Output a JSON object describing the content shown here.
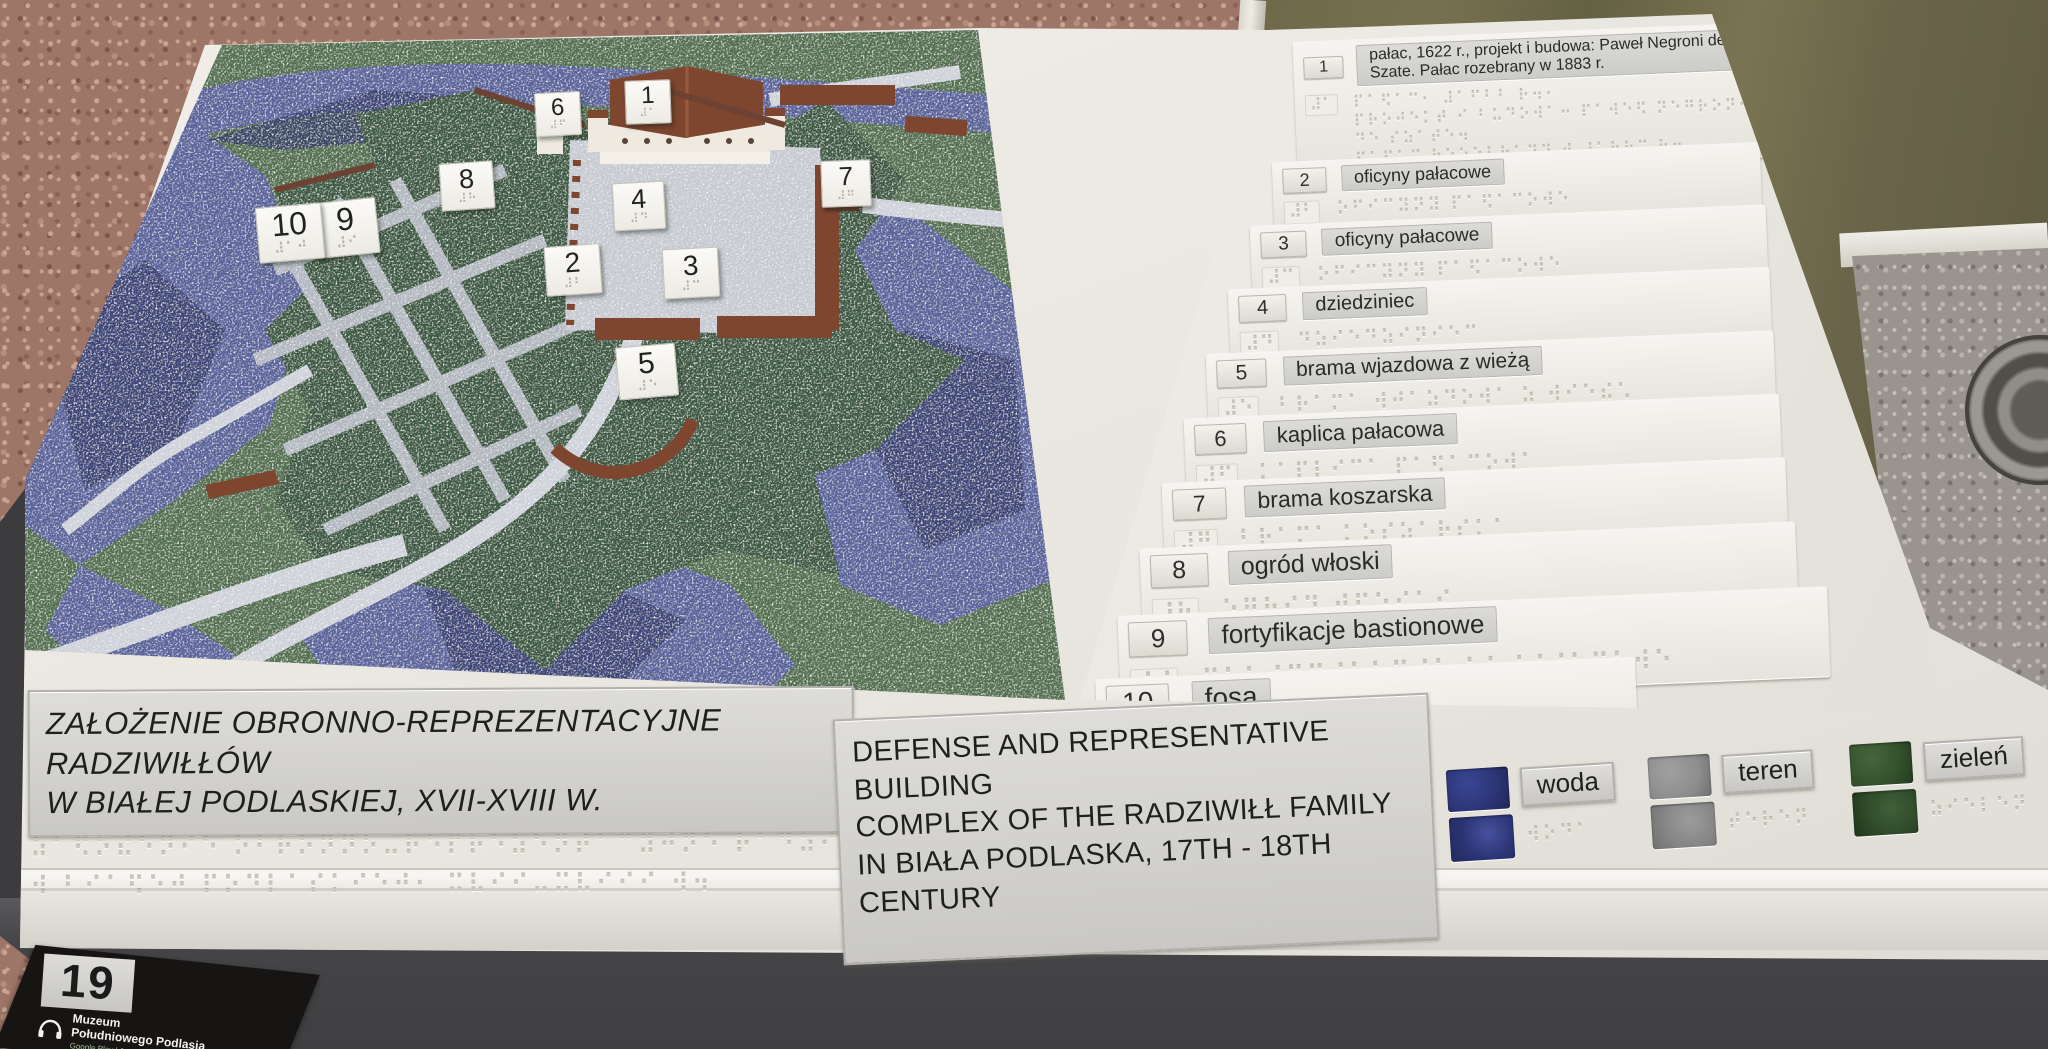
{
  "plaque": {
    "number": "19",
    "museum_line1": "Muzeum",
    "museum_line2": "Południowego Podlasia",
    "stores_line": "Google Play | App Store"
  },
  "titles": {
    "polish_line1": "ZAŁOŻENIE OBRONNO-REPREZENTACYJNE RADZIWIŁŁÓW",
    "polish_line2": "W BIAŁEJ PODLASKIEJ, XVII-XVIII W.",
    "polish_braille_lines": [
      "⠵⠁⠫⠕⠮⠑⠝⠊⠑ ⠕⠃⠗⠕⠝⠝⠕⠤⠗⠑⠏⠗⠑⠵⠑⠝⠞⠁⠉⠽⠚⠝⠑ ⠗⠁⠙⠵⠊⠺⠊⠫⠫⠪⠺",
      "⠺ ⠃⠊⠁⠫⠑⠚ ⠏⠕⠙⠇⠁⠎⠅⠊⠑⠚⠂ ⠭⠧⠊⠊⠤⠭⠧⠊⠊⠊ ⠺⠲"
    ],
    "english_line1": "DEFENSE AND REPRESENTATIVE BUILDING",
    "english_line2": "COMPLEX OF THE RADZIWIŁŁ FAMILY",
    "english_line3": "IN BIAŁA PODLASKA, 17TH - 18TH CENTURY"
  },
  "legend": {
    "items": [
      {
        "num": "1",
        "label": "pałac, 1622 r., projekt i budowa: Paweł Negroni de Szate. Pałac rozebrany w 1883 r.",
        "braille_num": "⠼⠁",
        "braille_lines": [
          "⠏⠁⠫⠁⠉⠂ ⠼⠁⠋⠃⠃ ⠗⠲⠂",
          "⠏⠗⠕⠚⠑⠅⠞ ⠊ ⠃⠥⠙⠕⠺⠁⠒ ⠏⠁⠺⠑⠫ ⠝⠑⠛⠗⠕⠝⠊ ⠙⠑ ⠎⠵⠁⠞⠑⠲",
          "⠏⠁⠫⠁⠉ ⠗⠕⠵⠑⠃⠗⠁⠝⠽ ⠺ ⠼⠁⠓⠓⠉ ⠗⠲"
        ]
      },
      {
        "num": "2",
        "label": "oficyny pałacowe",
        "braille_num": "⠼⠃",
        "braille_lines": [
          "⠕⠋⠊⠉⠽⠝⠽ ⠏⠁⠫⠁⠉⠕⠺⠑"
        ]
      },
      {
        "num": "3",
        "label": "oficyny pałacowe",
        "braille_num": "⠼⠉",
        "braille_lines": [
          "⠕⠋⠊⠉⠽⠝⠽ ⠏⠁⠫⠁⠉⠕⠺⠑"
        ]
      },
      {
        "num": "4",
        "label": "dziedziniec",
        "braille_num": "⠼⠙",
        "braille_lines": [
          "⠙⠵⠊⠑⠙⠵⠊⠝⠊⠑⠉"
        ]
      },
      {
        "num": "5",
        "label": "brama wjazdowa z wieżą",
        "braille_num": "⠼⠑",
        "braille_lines": [
          "⠃⠗⠁⠍⠁ ⠺⠚⠁⠵⠙⠕⠺⠁ ⠵ ⠺⠊⠑⠮⠡"
        ]
      },
      {
        "num": "6",
        "label": "kaplica pałacowa",
        "braille_num": "⠼⠋",
        "braille_lines": [
          "⠅⠁⠏⠇⠊⠉⠁ ⠏⠁⠫⠁⠉⠕⠺⠁"
        ]
      },
      {
        "num": "7",
        "label": "brama koszarska",
        "braille_num": "⠼⠛",
        "braille_lines": [
          "⠃⠗⠁⠍⠁ ⠅⠕⠎⠵⠁⠗⠎⠅⠁"
        ]
      },
      {
        "num": "8",
        "label": "ogród włoski",
        "braille_num": "⠼⠓",
        "braille_lines": [
          "⠕⠛⠗⠪⠙ ⠺⠫⠕⠎⠅⠊"
        ]
      },
      {
        "num": "9",
        "label": "fortyfikacje bastionowe",
        "braille_num": "⠼⠊",
        "braille_lines": [
          "⠋⠕⠗⠞⠽⠋⠊⠅⠁⠉⠚⠑ ⠃⠁⠎⠞⠊⠕⠝⠕⠺⠑"
        ]
      },
      {
        "num": "10",
        "label": "fosa",
        "braille_num": "⠼⠁⠚",
        "braille_lines": [
          "⠋⠕⠎⠁"
        ]
      }
    ]
  },
  "color_legend": {
    "entries": [
      {
        "label": "woda",
        "braille": "⠺⠕⠙⠁",
        "color": "#2b3474"
      },
      {
        "label": "teren",
        "braille": "⠞⠑⠗⠑⠝",
        "color": "#8d8d8d"
      },
      {
        "label": "zieleń",
        "braille": "⠵⠊⠑⠇⠑⠝",
        "color": "#33502c"
      }
    ]
  },
  "map": {
    "markers": [
      {
        "num": "1",
        "braille": "⠼⠁"
      },
      {
        "num": "2",
        "braille": "⠼⠃"
      },
      {
        "num": "3",
        "braille": "⠼⠉"
      },
      {
        "num": "4",
        "braille": "⠼⠙"
      },
      {
        "num": "5",
        "braille": "⠼⠑"
      },
      {
        "num": "6",
        "braille": "⠼⠋"
      },
      {
        "num": "7",
        "braille": "⠼⠛"
      },
      {
        "num": "8",
        "braille": "⠼⠓"
      },
      {
        "num": "9",
        "braille": "⠼⠊"
      },
      {
        "num": "10",
        "braille": "⠼⠁⠚"
      }
    ]
  }
}
